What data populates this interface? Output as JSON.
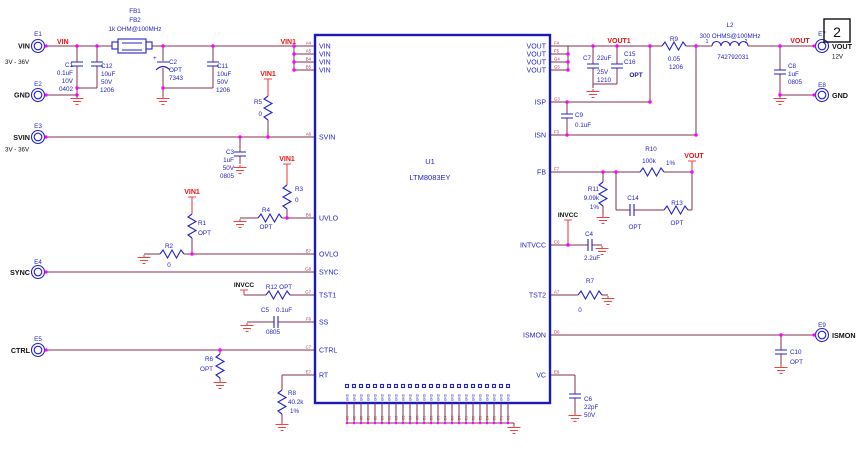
{
  "page": {
    "number": "2"
  },
  "ic": {
    "refdes": "U1",
    "part": "LTM8083EY",
    "gnd_pin_label": "GND"
  },
  "pins": {
    "left": [
      {
        "des": "A4",
        "name": "VIN"
      },
      {
        "des": "A5",
        "name": "VIN"
      },
      {
        "des": "B4",
        "name": "VIN"
      },
      {
        "des": "B5",
        "name": "VIN"
      },
      {
        "des": "A6",
        "name": "SVIN"
      },
      {
        "des": "B6",
        "name": "UVLO"
      },
      {
        "des": "B7",
        "name": "OVLO"
      },
      {
        "des": "G8",
        "name": "SYNC"
      },
      {
        "des": "G7",
        "name": "TST1"
      },
      {
        "des": "F6",
        "name": "SS"
      },
      {
        "des": "C7",
        "name": "CTRL"
      },
      {
        "des": "E7",
        "name": "RT"
      }
    ],
    "right": [
      {
        "des": "F4",
        "name": "VOUT"
      },
      {
        "des": "F5",
        "name": "VOUT"
      },
      {
        "des": "G4",
        "name": "VOUT"
      },
      {
        "des": "G5",
        "name": "VOUT"
      },
      {
        "des": "G3",
        "name": "ISP"
      },
      {
        "des": "F3",
        "name": "ISN"
      },
      {
        "des": "F7",
        "name": "FB"
      },
      {
        "des": "C6",
        "name": "INTVCC"
      },
      {
        "des": "A7",
        "name": "TST2"
      },
      {
        "des": "D6",
        "name": "ISMON"
      },
      {
        "des": "E6",
        "name": "VC"
      }
    ],
    "bottom": [
      "A1",
      "A2",
      "A3",
      "B1",
      "B2",
      "B3",
      "C1",
      "C2",
      "C3",
      "C4",
      "C5",
      "D1",
      "D2",
      "D3",
      "D4",
      "D5",
      "D7",
      "E1",
      "E2",
      "E3",
      "E4",
      "E5",
      "F1",
      "G1"
    ]
  },
  "connectors": {
    "e1": {
      "ref": "E1",
      "name": "VIN",
      "sub": "3V - 36V"
    },
    "e2": {
      "ref": "E2",
      "name": "GND"
    },
    "e3": {
      "ref": "E3",
      "name": "SVIN",
      "sub": "3V - 36V"
    },
    "e4": {
      "ref": "E4",
      "name": "SYNC"
    },
    "e5": {
      "ref": "E5",
      "name": "CTRL"
    },
    "e7": {
      "ref": "E7",
      "name": "VOUT",
      "sub": "12V"
    },
    "e8": {
      "ref": "E8",
      "name": "GND"
    },
    "e9": {
      "ref": "E9",
      "name": "ISMON"
    }
  },
  "nets": {
    "vin": "VIN",
    "vin1": "VIN1",
    "vout1": "VOUT1",
    "vout": "VOUT",
    "invcc": "INVCC"
  },
  "components": {
    "fb": {
      "ref1": "FB1",
      "ref2": "FB2",
      "value": "1k OHM@100MHz"
    },
    "c1": {
      "ref": "C1",
      "value": "0.1uF",
      "v": "10V",
      "pkg": "0402"
    },
    "c12": {
      "ref": "C12",
      "value": "10uF",
      "v": "50V",
      "pkg": "1206"
    },
    "c2": {
      "ref": "C2",
      "value": "OPT",
      "pkg": "7343",
      "plus": "+"
    },
    "c11": {
      "ref": "C11",
      "value": "10uF",
      "v": "50V",
      "pkg": "1206"
    },
    "r5": {
      "ref": "R5",
      "value": "0"
    },
    "c3": {
      "ref": "C3",
      "value": "1uF",
      "v": "50V",
      "pkg": "0805"
    },
    "r3": {
      "ref": "R3",
      "value": "0"
    },
    "r4": {
      "ref": "R4",
      "value": "OPT"
    },
    "r1": {
      "ref": "R1",
      "value": "OPT"
    },
    "r2": {
      "ref": "R2",
      "value": "0"
    },
    "r12": {
      "ref": "R12 OPT"
    },
    "c5": {
      "ref": "C5",
      "value": "0.1uF",
      "pkg": "0805"
    },
    "r6": {
      "ref": "R6",
      "value": "OPT"
    },
    "r8": {
      "ref": "R8",
      "value": "40.2k",
      "tol": "1%"
    },
    "c7": {
      "ref": "C7",
      "value": "22uF",
      "v": "25V",
      "pkg": "1210"
    },
    "c15": {
      "ref": "C15"
    },
    "c16": {
      "ref": "C16",
      "value": "OPT"
    },
    "c9": {
      "ref": "C9",
      "value": "0.1uF"
    },
    "r9": {
      "ref": "R9",
      "value": "0.05",
      "pkg": "1206"
    },
    "l2": {
      "ref": "L2",
      "value": "300 OHMS@100MHz",
      "mpn": "742792031",
      "pin1": "1",
      "pin2": "2"
    },
    "r10": {
      "ref": "R10",
      "value": "100k",
      "tol": "1%"
    },
    "r11": {
      "ref": "R11",
      "value": "9.09k",
      "tol": "1%"
    },
    "c14": {
      "ref": "C14",
      "value": "OPT"
    },
    "r13": {
      "ref": "R13",
      "value": "OPT"
    },
    "c4": {
      "ref": "C4",
      "value": "2.2uF"
    },
    "r7": {
      "ref": "R7",
      "value": "0"
    },
    "c10": {
      "ref": "C10",
      "value": "OPT"
    },
    "c6": {
      "ref": "C6",
      "value": "22pF",
      "v": "50V"
    },
    "c8": {
      "ref": "C8",
      "value": "1uF",
      "pkg": "0805"
    }
  },
  "colors": {
    "wire": "#803050",
    "symbol": "#2323cc",
    "net_label": "#ee1111",
    "ground": "#ee4444",
    "ic_border": "#1a1ab8",
    "junction": "#ff00ff",
    "designator": "#993355",
    "text": "#111111"
  }
}
